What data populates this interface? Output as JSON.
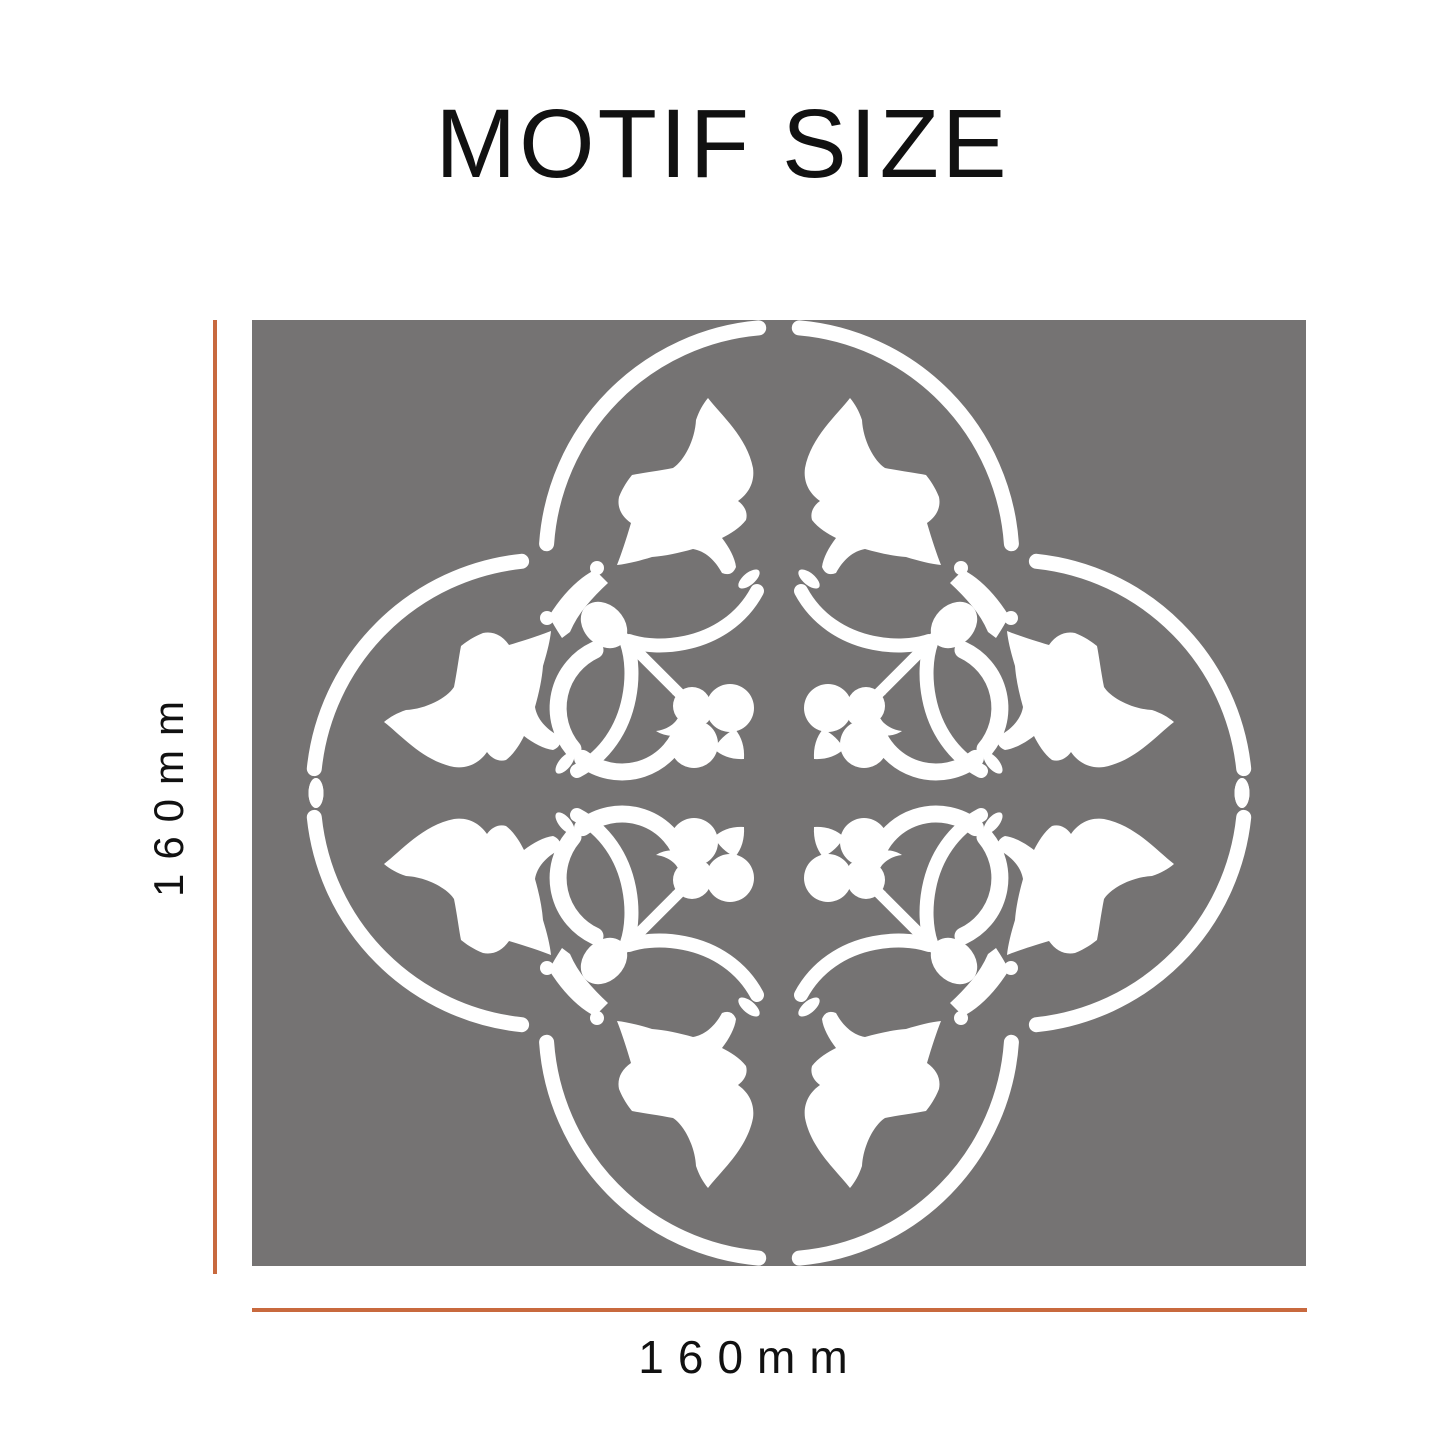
{
  "title": "MOTIF SIZE",
  "dimension_labels": {
    "height": "160mm",
    "width": "160mm"
  },
  "colors": {
    "page_background": "#ffffff",
    "stencil_background": "#757373",
    "motif": "#ffffff",
    "dimension_line": "#C8693E",
    "title_text": "#111111",
    "label_text": "#111111"
  },
  "motif": {
    "name": "floral-quatrefoil-stencil",
    "lobes": 4,
    "leaves": 8,
    "trefoil_sprigs": 4,
    "scroll_curls": 4
  }
}
